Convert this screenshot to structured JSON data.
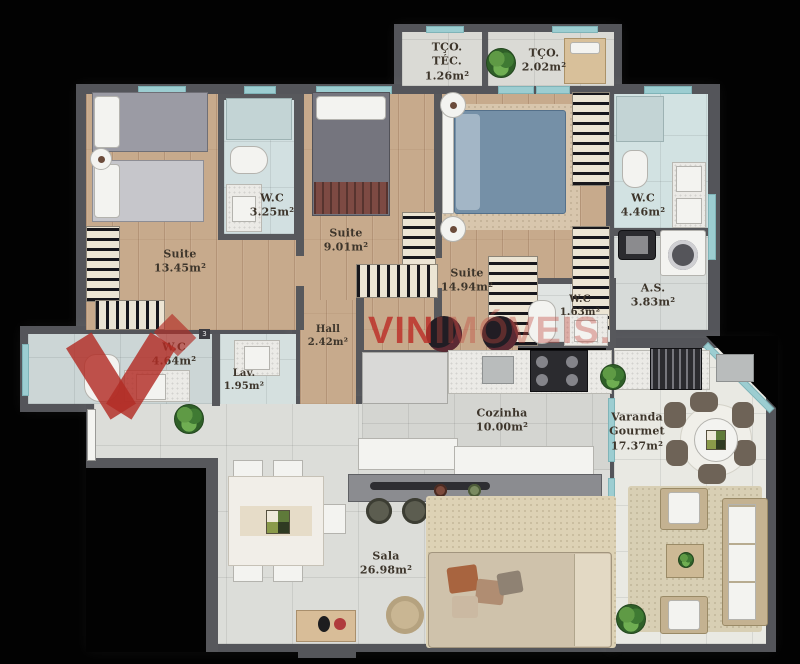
{
  "title": "apartment-floor-plan",
  "watermark": {
    "brand_strong": "VIN",
    "brand_faint": "IMÓVEIS.",
    "color": "#bc322a"
  },
  "wall_marker": {
    "text": "3"
  },
  "palette": {
    "background": "#020202",
    "wall": "#57585c",
    "wood_floor": "#c7aa8c",
    "tile_floor": "#dcddd9",
    "wet_area_tile": "#d2e0e1",
    "window_glass": "#9ccdd1",
    "watermark_red": "#bc322a"
  },
  "rooms": [
    {
      "name": "TÇO. TÉC.",
      "area": "1.26m²"
    },
    {
      "name": "TÇO.",
      "area": "2.02m²"
    },
    {
      "name": "Suite",
      "area": "13.45m²"
    },
    {
      "name": "W.C",
      "area": "3.25m²"
    },
    {
      "name": "Suite",
      "area": "9.01m²"
    },
    {
      "name": "Suite",
      "area": "14.94m²"
    },
    {
      "name": "W.C",
      "area": "4.46m²"
    },
    {
      "name": "A.S.",
      "area": "3.83m²"
    },
    {
      "name": "W.C",
      "area": "1.63m²"
    },
    {
      "name": "Hall",
      "area": "2.42m²"
    },
    {
      "name": "W.C",
      "area": "4.64m²"
    },
    {
      "name": "Lav.",
      "area": "1.95m²"
    },
    {
      "name": "Cozinha",
      "area": "10.00m²"
    },
    {
      "name": "Varanda Gourmet",
      "area": "17.37m²"
    },
    {
      "name": "Sala",
      "area": "26.98m²"
    }
  ]
}
